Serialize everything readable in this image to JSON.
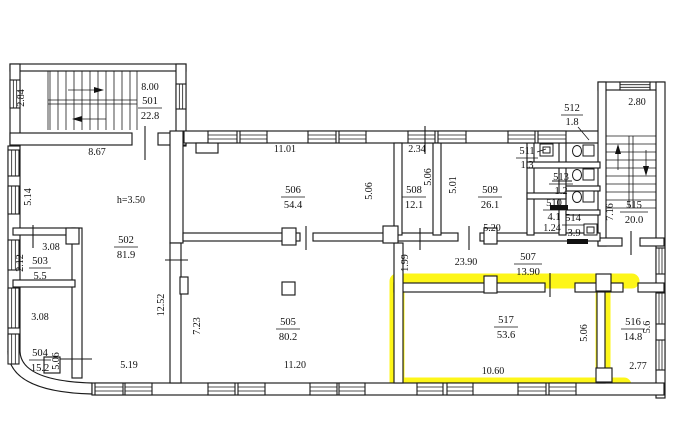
{
  "plan": {
    "highlight": {
      "room": "517",
      "color": "#fdf500"
    },
    "rooms": {
      "r501": {
        "number": "501",
        "area": "22.8"
      },
      "r502": {
        "number": "502",
        "area": "81.9"
      },
      "r503": {
        "number": "503",
        "area": "5.5"
      },
      "r504": {
        "number": "504",
        "area": "15.2"
      },
      "r505": {
        "number": "505",
        "area": "80.2"
      },
      "r506": {
        "number": "506",
        "area": "54.4"
      },
      "r507": {
        "number": "507",
        "area": "13.90"
      },
      "r508": {
        "number": "508",
        "area": "12.1"
      },
      "r509": {
        "number": "509",
        "area": "26.1"
      },
      "r510": {
        "number": "510",
        "area": "4.1"
      },
      "r511": {
        "number": "511",
        "area": "1.3"
      },
      "r512": {
        "number": "512",
        "area": "1.8"
      },
      "r513": {
        "number": "513",
        "area": "1.2"
      },
      "r514": {
        "number": "514",
        "area": "3.9"
      },
      "r515": {
        "number": "515",
        "area": "20.0"
      },
      "r516": {
        "number": "516",
        "area": "14.8"
      },
      "r517": {
        "number": "517",
        "area": "53.6",
        "highlighted": true
      }
    },
    "dims": {
      "d_8_00": "8.00",
      "d_2_84": "2.84",
      "d_8_67": "8.67",
      "d_5_14": "5.14",
      "d_h350": "h=3.50",
      "d_5_19": "5.19",
      "d_3_08a": "3.08",
      "d_2_12": "2.12",
      "d_3_08b": "3.08",
      "d_5_06a": "5.06",
      "d_12_52": "12.52",
      "d_7_23": "7.23",
      "d_11_20": "11.20",
      "d_11_01": "11.01",
      "d_5_06b": "5.06",
      "d_2_34": "2.34",
      "d_5_06c": "5.06",
      "d_5_01": "5.01",
      "d_5_20": "5.20",
      "d_1_24": "1.24",
      "d_1_99": "1.99",
      "d_23_90": "23.90",
      "d_2_80": "2.80",
      "d_7_16": "7.16",
      "d_10_60": "10.60",
      "d_5_06d": "5.06",
      "d_5_6": "5.6",
      "d_2_77": "2.77"
    }
  }
}
